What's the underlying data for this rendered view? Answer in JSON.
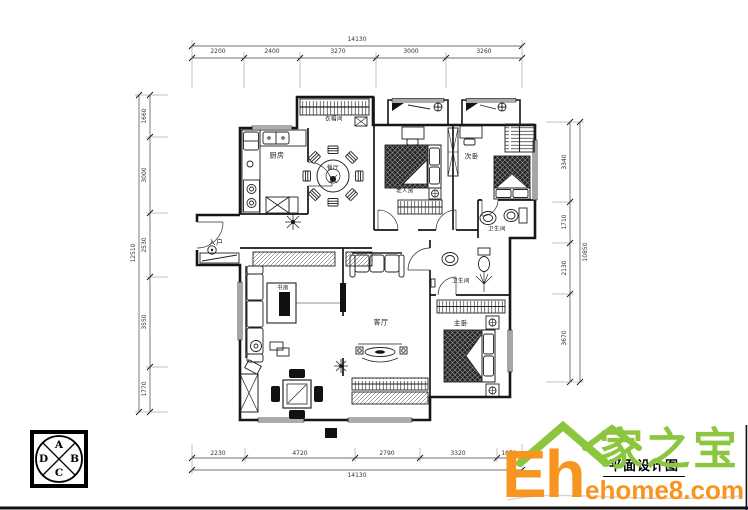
{
  "drawing": {
    "title": "平面设计图"
  },
  "logo": {
    "name_cn": "家之宝",
    "name_short": "Eh",
    "domain": "ehome8.com",
    "green": "#8CC63F",
    "orange": "#F89420"
  },
  "compass": {
    "a": "A",
    "b": "B",
    "c": "C",
    "d": "D"
  },
  "rooms": [
    {
      "name": "kitchen",
      "label": "厨房"
    },
    {
      "name": "dining",
      "label": "餐厅"
    },
    {
      "name": "cloakroom",
      "label": "衣帽间"
    },
    {
      "name": "elder-bedroom",
      "label": "老人房"
    },
    {
      "name": "second-bedroom",
      "label": "次卧"
    },
    {
      "name": "bath-1",
      "label": "卫生间"
    },
    {
      "name": "entry",
      "label": "入户"
    },
    {
      "name": "study",
      "label": "书房"
    },
    {
      "name": "living-room",
      "label": "客厅"
    },
    {
      "name": "bath-2",
      "label": "卫生间"
    },
    {
      "name": "master-bedroom",
      "label": "主卧"
    }
  ],
  "dimensions": {
    "top": {
      "total": "14130",
      "segments": [
        "2200",
        "2400",
        "3270",
        "3000",
        "3260"
      ]
    },
    "bottom": {
      "total": "14130",
      "segments": [
        "2230",
        "4720",
        "2790",
        "3320",
        "1070"
      ]
    },
    "left": {
      "total": "12510",
      "segments": [
        "1660",
        "3000",
        "2530",
        "3550",
        "1770"
      ]
    },
    "right": {
      "total": "10850",
      "segments": [
        "3340",
        "1710",
        "2130",
        "3670"
      ]
    }
  }
}
